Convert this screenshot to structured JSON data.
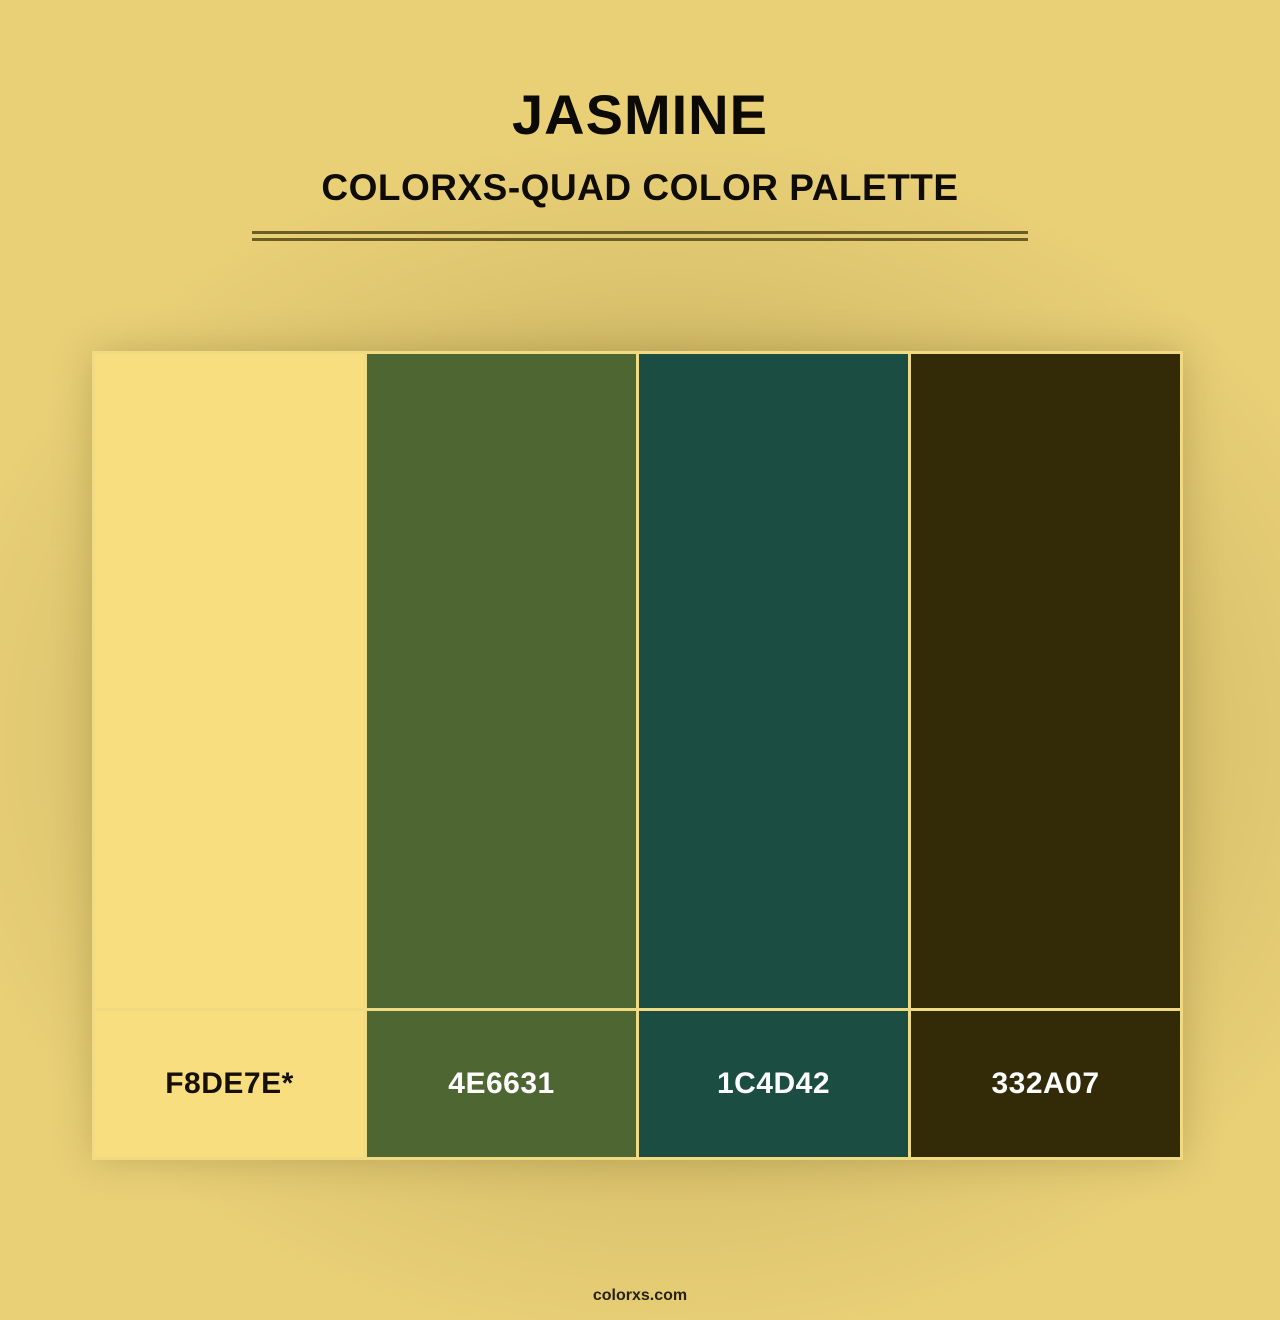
{
  "header": {
    "title": "JASMINE",
    "subtitle": "COLORXS-QUAD COLOR PALETTE"
  },
  "palette": {
    "name": "Jasmine",
    "swatches": [
      {
        "hex": "#F8DE7E",
        "label": "F8DE7E*",
        "text_color": "#151003"
      },
      {
        "hex": "#4E6631",
        "label": "4E6631",
        "text_color": "#ffffff"
      },
      {
        "hex": "#1C4D42",
        "label": "1C4D42",
        "text_color": "#ffffff"
      },
      {
        "hex": "#332A07",
        "label": "332A07",
        "text_color": "#ffffff"
      }
    ]
  },
  "footer": {
    "text": "colorxs.com"
  },
  "colors": {
    "background": "#e9d077",
    "vignette": "#4a3a0e",
    "divider": "#6a5e24",
    "grid_border": "#f0db82",
    "title_text": "#0b0a04"
  }
}
